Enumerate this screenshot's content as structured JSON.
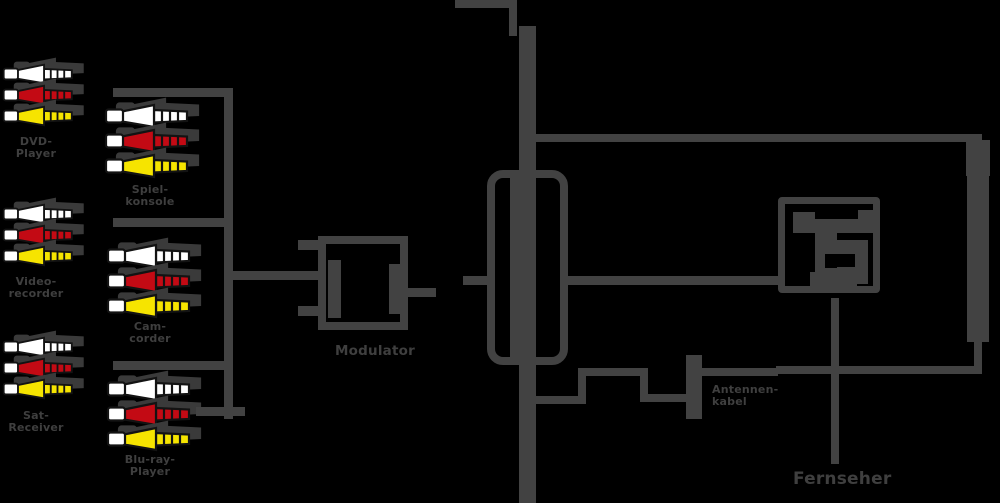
{
  "colors": {
    "background": "#000000",
    "line": "#424242",
    "shadow": "#3a3a3a",
    "label": "#3f3f3f",
    "plug_white": "#ffffff",
    "plug_red": "#c30a14",
    "plug_yellow": "#f6e400",
    "plug_outline": "#131313"
  },
  "sources": {
    "column1": [
      {
        "label_line1": "DVD-",
        "label_line2": "Player"
      },
      {
        "label_line1": "Video-",
        "label_line2": "recorder"
      },
      {
        "label_line1": "Sat-",
        "label_line2": "Receiver"
      }
    ],
    "column2": [
      {
        "label_line1": "Spiel-",
        "label_line2": "konsole"
      },
      {
        "label_line1": "Cam-",
        "label_line2": "corder"
      },
      {
        "label_line1": "Blu-ray-",
        "label_line2": "Player"
      }
    ]
  },
  "modulator": {
    "label": "Modulator"
  },
  "antenna_cable": {
    "label_line1": "Antennen-",
    "label_line2": "kabel"
  },
  "tv": {
    "label": "Fernseher"
  },
  "icons": {
    "plug": "rca-cinch-plug-icon",
    "modulator": "modulator-icon",
    "amplifier": "inline-amplifier-icon",
    "socket": "antenna-wall-socket-icon"
  }
}
